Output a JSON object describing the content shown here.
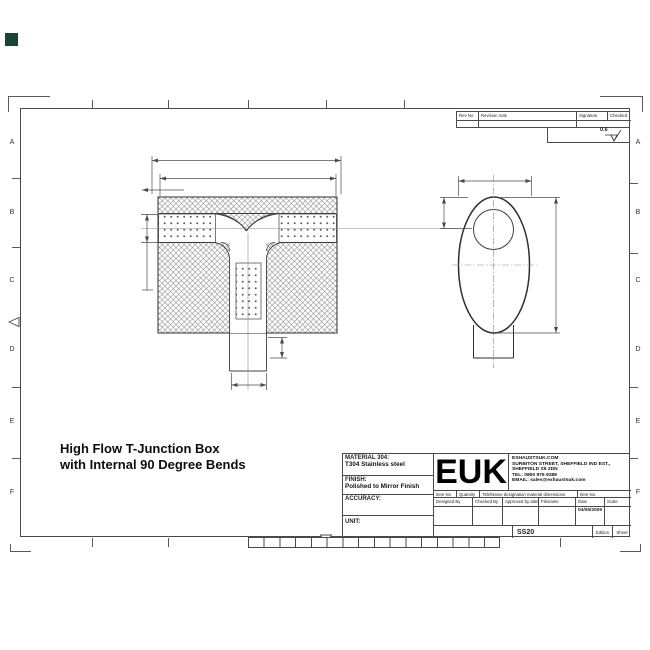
{
  "colors": {
    "line": "#4a4a4a",
    "drawing_stroke": "#3f3f3f",
    "background": "#ffffff",
    "corner_square": "#1c4435"
  },
  "frame": {
    "row_labels": [
      "A",
      "B",
      "C",
      "D",
      "E",
      "F"
    ]
  },
  "drawing_title": {
    "line1": "High Flow T-Junction Box",
    "line2": "with Internal 90 Degree Bends"
  },
  "revision_table": {
    "rev_no": "Rev No",
    "revision_note": "Revision note",
    "signature": "Signature",
    "checked": "Checked",
    "surface_finish_value": "0.6"
  },
  "title_block": {
    "material_label": "MATERIAL 304:",
    "material_value": "T304 Stainless steel",
    "finish_label": "FINISH:",
    "finish_value": "Polished to Mirror Finish",
    "accuracy_label": "ACCURACY:",
    "unit_label": "UNIT:",
    "logo": "EUK",
    "company": {
      "line1": "EXHAUSTSUK.COM",
      "line2": "SURBITON STREET, SHEFFIELD IND EST.,",
      "line3": "SHEFFIELD S9 2DN",
      "line4": "TEL: 0800 975 9288",
      "line5": "EMAIL: sales@exhaustsuk.com"
    },
    "row1": [
      "Item No",
      "Quantity",
      "Title/Name designation material dimensions",
      "Item No."
    ],
    "row2": [
      "Designed By",
      "Checked By",
      "Approved by date",
      "Filename",
      "Date",
      "Scale"
    ],
    "date_value": "04/06/2009",
    "part_number": "SS20",
    "edition_label": "Edition",
    "sheet_label": "Sheet"
  }
}
